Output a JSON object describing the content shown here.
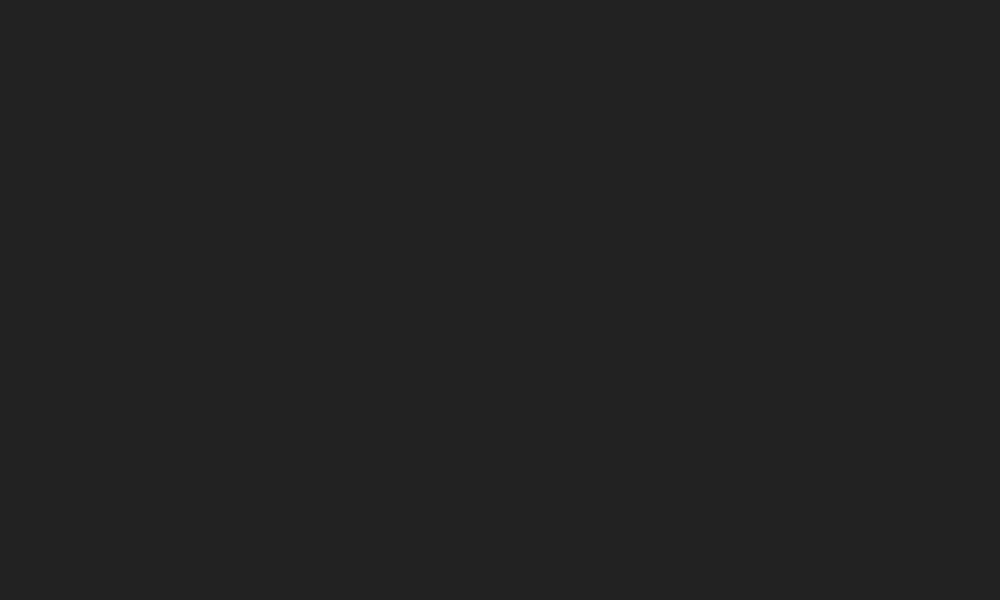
{
  "meta": {
    "aria_label": "Aerial 3D rendering of a seaside resort with hotel, swimming pools, waterslides, palm-dotted sand beach and turquoise sea",
    "canvas": {
      "w": 1000,
      "h": 600
    }
  },
  "palette": {
    "sand": "#e4c084",
    "sand_bright": "#f2e2b4",
    "sand_wet": "#e3d2a6",
    "foam": "#fbf9ef",
    "sea_shallow": "#86d8c8",
    "sea_mid": "#3bb9aa",
    "sea_deep": "#149b90",
    "sea_dark": "#0c8a80",
    "sea_light": "#bfe8d8",
    "deck": "#f0eeea",
    "deck_cream": "#eae0cd",
    "joint": "rgba(110,128,76,0.45)",
    "wood": "#a85c36",
    "wood_dark": "#8f4a2a",
    "coping": "#f8f7f3",
    "water_light": "#a8e2ee",
    "water_deep": "#4ab4d2",
    "kids_light": "#bfeaf2",
    "kids_deep": "#6cc8dc",
    "stripe_dark": "#30343f",
    "stripe_light": "#e9e9e7",
    "wall_face": "#edebe7",
    "wall_trim": "#a04848",
    "garden": "#4a7c38",
    "garden_dark": "#39622d",
    "garden_light": "#568c42",
    "brick": "#c49a8e",
    "brick_dark": "#ab8278",
    "deck_sand": "#ead7a4",
    "umb_yellow": "#e9a52d",
    "umb_blue": "#2f6cb8",
    "umb_white": "#f1ede2",
    "umb_orange": "#e08a28",
    "umb_teal": "#3aa8a0",
    "straw": "#d9a95e",
    "straw_rib": "#a87f42",
    "straw_center": "#6b4f2c",
    "lounger": "#f6f4ee",
    "lounger_stripe": "#d9d2c5",
    "bush_dark": "#2a4f23",
    "bush_a": "#365f2c",
    "bush_b": "#49803a",
    "bush_tip": "#6fa04c",
    "bush_fruit": "#c9a23f",
    "palm_a": "#2d5a2a",
    "palm_b": "#3f7336",
    "palm_c": "#548a40",
    "trunk": "#8a6a4a",
    "roof": "#edeff1",
    "roof_trim": "#4e2342",
    "facade": "#dfe3e8",
    "facade_sw": "#d6dae2",
    "window": "#2b3340",
    "mullion": "#e8eaee",
    "balcony": "#f4f5f8",
    "slide_red": "#d6403a",
    "slide_blue": "#2e7bc0",
    "slide_yellow": "#e8b02d",
    "play_pink": "#e055a0",
    "play_purple": "#8d4fc0",
    "play_red": "#d64444",
    "play_yellow": "#e8c032",
    "play_blue": "#3f8fd8",
    "boat_red": "#d84040",
    "raft_yellow": "#e8c845",
    "skin": "#e8bb90",
    "shadow": "rgba(0,0,0,0.22)",
    "sand_shadow": "rgba(115,88,48,0.38)"
  },
  "ocean": {
    "foam_pts": [
      [
        1028,
        -30
      ],
      [
        1004,
        40
      ],
      [
        952,
        200
      ],
      [
        908,
        340
      ],
      [
        868,
        480
      ],
      [
        838,
        598
      ]
    ],
    "perp": [
      0.958,
      0.285
    ],
    "swimmer_count": 22,
    "walker_count": 8,
    "seed": 11
  },
  "fence": {
    "pts": [
      [
        891,
        292
      ],
      [
        879,
        332
      ],
      [
        839,
        472
      ],
      [
        809,
        590
      ]
    ],
    "post_gap": 24
  },
  "platform": {
    "quad": [
      [
        180,
        46
      ],
      [
        692,
        276
      ],
      [
        628,
        462
      ],
      [
        0,
        248
      ]
    ],
    "outline": [
      [
        180,
        46
      ],
      [
        692,
        276
      ],
      [
        628,
        462
      ],
      [
        0,
        248
      ],
      [
        0,
        60
      ]
    ],
    "grid": {
      "s_min": -0.36,
      "s_max": 0.96,
      "s_step": 0.06,
      "t_step": 0.15
    },
    "cream_patches": [
      [
        -0.34,
        0.3,
        0.02,
        0.95
      ],
      [
        0.13,
        0.62,
        0.44,
        0.93
      ],
      [
        0.44,
        0.52,
        0.56,
        0.95
      ]
    ],
    "wall": {
      "h": 11,
      "stripe": 4.4,
      "shadow_w": 9
    },
    "dark_zone": [
      0.005,
      0.02,
      0.27,
      0.3
    ],
    "deck_tents": [
      {
        "t": 0.17,
        "s0": 0.045,
        "s1": 0.225,
        "n": 4
      },
      {
        "t": 0.33,
        "s0": 0.03,
        "s1": 0.27,
        "n": 5
      },
      {
        "t": 0.45,
        "s0": 0.06,
        "s1": 0.3,
        "n": 5
      }
    ],
    "gardens": [
      [
        0.46,
        0.05,
        0.545,
        0.45
      ],
      [
        0.425,
        0.18,
        0.475,
        0.52
      ],
      [
        0.56,
        0.42,
        0.8,
        0.97
      ],
      [
        0.8,
        0.5,
        0.985,
        0.98
      ],
      [
        0.9,
        0.02,
        0.985,
        0.35
      ]
    ],
    "garden_palms": [
      [
        0.53,
        0.12
      ],
      [
        0.545,
        0.38
      ],
      [
        0.62,
        0.55
      ],
      [
        0.7,
        0.78
      ],
      [
        0.78,
        0.62
      ],
      [
        0.88,
        0.93
      ],
      [
        0.93,
        0.28
      ],
      [
        0.955,
        0.75
      ],
      [
        0.67,
        0.93
      ],
      [
        0.6,
        0.7
      ]
    ],
    "sand_patch": [
      0.76,
      0.28,
      0.95,
      0.58
    ],
    "brick_path": [
      0.95,
      0.0,
      1.0,
      1.0
    ],
    "pools": [
      {
        "id": "main-pool",
        "border": [
          0.115,
          0.195,
          0.465,
          0.6
        ],
        "water": [
          0.16,
          0.28,
          0.42,
          0.52
        ],
        "kids": false,
        "floats": true,
        "rows": [
          {
            "t": 0.225,
            "s0": 0.17,
            "s1": 0.41,
            "n": 7,
            "colors": [
              "yellow",
              "blue",
              "white",
              "yellow",
              "blue",
              "white",
              "yellow"
            ]
          },
          {
            "t": 0.565,
            "s0": 0.155,
            "s1": 0.435,
            "n": 8,
            "colors": [
              "blue",
              "yellow",
              "white",
              "blue",
              "yellow",
              "white",
              "blue",
              "yellow"
            ]
          }
        ],
        "ends": [
          [
            0.135,
            0.33,
            "white"
          ],
          [
            0.135,
            0.47,
            "blue"
          ]
        ],
        "swimmers": [
          [
            0.22,
            0.35
          ],
          [
            0.25,
            0.45
          ],
          [
            0.3,
            0.33
          ],
          [
            0.34,
            0.42
          ],
          [
            0.38,
            0.37
          ],
          [
            0.27,
            0.5
          ],
          [
            0.2,
            0.42
          ],
          [
            0.36,
            0.48
          ]
        ]
      },
      {
        "id": "slide-pool",
        "border": [
          0.53,
          0.08,
          0.82,
          0.44
        ],
        "water": [
          0.56,
          0.14,
          0.79,
          0.38
        ],
        "kids": false,
        "floats": false,
        "rows": [
          {
            "t": 0.445,
            "s0": 0.565,
            "s1": 0.775,
            "n": 6,
            "colors": [
              "blue",
              "white",
              "yellow",
              "blue",
              "white",
              "yellow"
            ]
          }
        ],
        "ends": [
          [
            0.565,
            0.075,
            "blue"
          ],
          [
            0.625,
            0.05,
            "yellow"
          ]
        ],
        "swimmers": [
          [
            0.6,
            0.2
          ],
          [
            0.645,
            0.3
          ],
          [
            0.7,
            0.18
          ],
          [
            0.74,
            0.28
          ],
          [
            0.62,
            0.33
          ]
        ]
      },
      {
        "id": "kids-pool",
        "border": [
          0.47,
          0.54,
          0.69,
          0.88
        ],
        "water": [
          0.5,
          0.6,
          0.66,
          0.82
        ],
        "kids": true,
        "floats": false,
        "rows": [],
        "ends": [
          [
            0.465,
            0.54,
            "blue"
          ],
          [
            0.45,
            0.72,
            "yellow"
          ],
          [
            0.685,
            0.6,
            "blue"
          ],
          [
            0.69,
            0.86,
            "yellow"
          ],
          [
            0.6,
            0.48,
            "white"
          ]
        ],
        "swimmers": [
          [
            0.54,
            0.68
          ],
          [
            0.58,
            0.76
          ],
          [
            0.62,
            0.66
          ]
        ]
      },
      {
        "id": "left-pool",
        "border": [
          -0.17,
          0.5,
          0.05,
          0.88
        ],
        "water": [
          -0.14,
          0.56,
          0.02,
          0.82
        ],
        "kids": false,
        "floats": false,
        "rows": [],
        "ends": [
          [
            -0.115,
            0.52,
            "blue"
          ],
          [
            0.035,
            0.62,
            "yellow"
          ]
        ],
        "swimmers": [
          [
            -0.05,
            0.68
          ],
          [
            -0.01,
            0.74
          ]
        ]
      }
    ],
    "extra_units": [
      [
        0.445,
        0.58,
        "blue"
      ],
      [
        0.475,
        0.66,
        "yellow"
      ],
      [
        0.445,
        0.74,
        "white"
      ],
      [
        0.505,
        0.78,
        "blue"
      ]
    ],
    "hut": {
      "s": 0.49,
      "t": 0.11,
      "w": 14,
      "h": 9
    },
    "terrace_tables": [
      [
        -0.06,
        0.72,
        "orange"
      ],
      [
        -0.02,
        0.8,
        "teal"
      ],
      [
        0.03,
        0.72,
        null
      ],
      [
        -0.05,
        0.9,
        "blue"
      ],
      [
        0.05,
        0.84,
        "yellow"
      ],
      [
        0.0,
        0.95,
        null
      ],
      [
        0.09,
        0.93,
        "orange"
      ],
      [
        0.07,
        0.63,
        null
      ],
      [
        0.14,
        0.68,
        "blue"
      ],
      [
        0.18,
        0.78,
        null
      ],
      [
        0.22,
        0.65,
        "orange"
      ],
      [
        0.26,
        0.76,
        "yellow"
      ],
      [
        0.3,
        0.68,
        null
      ],
      [
        0.34,
        0.78,
        "teal"
      ],
      [
        0.38,
        0.7,
        "orange"
      ],
      [
        0.42,
        0.8,
        null
      ],
      [
        0.24,
        0.88,
        "blue"
      ],
      [
        0.33,
        0.89,
        null
      ]
    ],
    "restaurant": {
      "s_vals": [
        0.81,
        0.86,
        0.91
      ],
      "t_vals": [
        0.58,
        0.68,
        0.78
      ]
    },
    "palm_row_s": [
      0.06,
      0.145,
      0.23,
      0.315,
      0.4,
      0.485,
      0.57,
      0.655,
      0.74,
      0.825,
      0.91
    ],
    "palm_row_t": 0.965,
    "left_palms": [
      [
        12,
        152
      ],
      [
        36,
        170
      ],
      [
        60,
        186
      ],
      [
        84,
        201
      ],
      [
        108,
        214
      ],
      [
        132,
        226
      ]
    ],
    "people": [
      [
        0.35,
        0.55
      ],
      [
        0.42,
        0.32
      ],
      [
        0.48,
        0.72
      ],
      [
        0.52,
        0.3
      ],
      [
        0.6,
        0.62
      ],
      [
        0.64,
        0.9
      ],
      [
        0.72,
        0.45
      ],
      [
        0.75,
        0.25
      ],
      [
        0.82,
        0.4
      ],
      [
        0.86,
        0.7
      ],
      [
        0.9,
        0.55
      ],
      [
        0.94,
        0.85
      ],
      [
        0.3,
        0.9
      ],
      [
        0.12,
        0.6
      ],
      [
        0.965,
        0.15
      ],
      [
        0.975,
        0.35
      ]
    ],
    "slide_anchor": [
      0.83,
      0.06
    ],
    "kids_anchor": [
      0.58,
      0.74
    ]
  },
  "building": {
    "roof": [
      [
        0,
        0
      ],
      [
        118,
        0
      ],
      [
        170,
        58
      ],
      [
        34,
        102
      ],
      [
        0,
        78
      ]
    ],
    "trim": [
      [
        118,
        0
      ],
      [
        170,
        58
      ],
      [
        34,
        102
      ]
    ],
    "facade_se": [
      [
        34,
        102
      ],
      [
        170,
        58
      ],
      [
        188,
        128
      ],
      [
        52,
        172
      ]
    ],
    "floors": 5,
    "mullions": 8,
    "facade_sw": [
      [
        0,
        78
      ],
      [
        34,
        102
      ],
      [
        52,
        172
      ],
      [
        0,
        148
      ]
    ],
    "balconies": {
      "rows": 4,
      "cols": 3
    }
  },
  "beach": {
    "grid_north": {
      "origin": [
        842,
        152
      ],
      "col": [
        30,
        13
      ],
      "row": [
        -11,
        23
      ],
      "cols": 3,
      "rows": 5
    },
    "grid_main": {
      "origin": [
        757,
        341
      ],
      "col": [
        38,
        1
      ],
      "row": [
        -9,
        31
      ],
      "cols_per_row": [
        3,
        4,
        4,
        4,
        4,
        3,
        3,
        2
      ]
    },
    "cabanas": [
      [
        694,
        346
      ],
      [
        706,
        372
      ],
      [
        719,
        399
      ]
    ],
    "steps": [
      [
        662,
        325
      ],
      [
        685,
        307
      ]
    ],
    "mats": [
      {
        "x": 810,
        "y": 188,
        "w": 54,
        "h": 17,
        "rot": 53,
        "stripe": "tan"
      },
      {
        "x": 666,
        "y": 287,
        "w": 34,
        "h": 13,
        "rot": 53,
        "stripe": "blue"
      }
    ],
    "boats": [
      [
        706,
        301
      ],
      [
        724,
        310
      ],
      [
        742,
        319
      ]
    ],
    "rafts": [
      [
        601,
        425
      ],
      [
        614,
        436
      ],
      [
        627,
        447
      ],
      [
        643,
        456
      ],
      [
        660,
        465
      ],
      [
        677,
        473
      ]
    ],
    "palms": [
      [
        886,
        312
      ],
      [
        870,
        392
      ],
      [
        856,
        448
      ],
      [
        840,
        504
      ],
      [
        822,
        558
      ],
      [
        655,
        578
      ]
    ],
    "gate": [
      687,
      269
    ]
  },
  "bushes": {
    "seed": 7,
    "min_dist": 27,
    "regions": [
      {
        "x": 185,
        "y": 4,
        "w": 760,
        "h": 146,
        "n": 40
      },
      {
        "x": 0,
        "y": 262,
        "w": 360,
        "h": 332,
        "n": 30
      },
      {
        "x": 360,
        "y": 430,
        "w": 330,
        "h": 165,
        "n": 13
      },
      {
        "x": 690,
        "y": 128,
        "w": 95,
        "h": 150,
        "n": 7
      }
    ],
    "exclude": [
      [
        690,
        320,
        885,
        585
      ],
      [
        585,
        410,
        700,
        492
      ],
      [
        676,
        325,
        742,
        425
      ],
      [
        690,
        286,
        762,
        334
      ],
      [
        780,
        148,
        845,
        225
      ],
      [
        795,
        138,
        912,
        285
      ],
      [
        0,
        0,
        205,
        118
      ],
      [
        640,
        290,
        710,
        350
      ]
    ]
  },
  "dunes": {
    "seed": 5,
    "count": 26
  }
}
